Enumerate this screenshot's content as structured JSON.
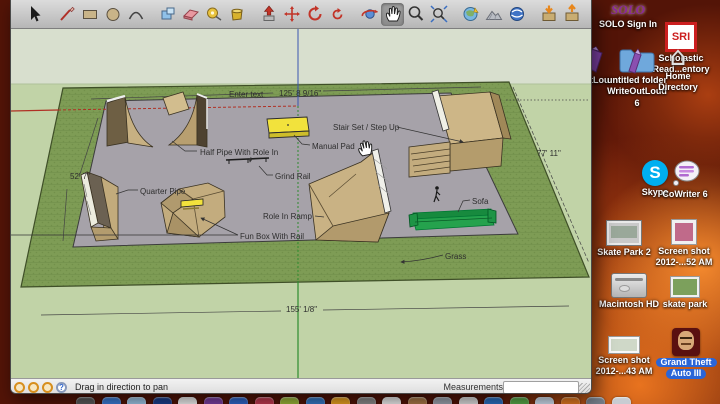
{
  "app": {
    "name": "SketchUp"
  },
  "toolbar": {
    "tools": [
      {
        "id": "select-tool",
        "icon": "select"
      },
      {
        "id": "line-tool",
        "icon": "line",
        "gap": true
      },
      {
        "id": "rectangle-tool",
        "icon": "rectangle"
      },
      {
        "id": "circle-tool",
        "icon": "circle"
      },
      {
        "id": "arc-tool",
        "icon": "arc"
      },
      {
        "id": "make-component-tool",
        "icon": "component",
        "gap": true
      },
      {
        "id": "eraser-tool",
        "icon": "eraser"
      },
      {
        "id": "tape-measure-tool",
        "icon": "tape"
      },
      {
        "id": "paint-bucket-tool",
        "icon": "bucket"
      },
      {
        "id": "push-pull-tool",
        "icon": "pushpull",
        "gap": true
      },
      {
        "id": "move-tool",
        "icon": "move"
      },
      {
        "id": "rotate-tool",
        "icon": "rotate"
      },
      {
        "id": "follow-me-tool",
        "icon": "followme"
      },
      {
        "id": "orbit-tool",
        "icon": "orbit",
        "gap": true
      },
      {
        "id": "pan-tool",
        "icon": "pan",
        "selected": true
      },
      {
        "id": "zoom-tool",
        "icon": "zoom"
      },
      {
        "id": "zoom-extents-tool",
        "icon": "zoomext"
      },
      {
        "id": "add-location-tool",
        "icon": "addloc",
        "gap": true
      },
      {
        "id": "toggle-terrain-tool",
        "icon": "terrain"
      },
      {
        "id": "photo-textures-tool",
        "icon": "phototex"
      },
      {
        "id": "get-models-tool",
        "icon": "getmodels",
        "gap": true
      },
      {
        "id": "share-model-tool",
        "icon": "sharemodel"
      }
    ]
  },
  "statusbar": {
    "hint": "Drag in direction to pan",
    "measurements_label": "Measurements",
    "measurements_value": "",
    "help_glyph": "?"
  },
  "viewport": {
    "cursor": "pan-hand",
    "labels": [
      {
        "id": "enter-text",
        "text": "Enter text",
        "x": 218,
        "y": 61
      },
      {
        "id": "dim-length-top",
        "text": "125' 8 9/16\"",
        "x": 268,
        "y": 60
      },
      {
        "id": "stair-set",
        "text": "Stair Set / Step Up",
        "x": 322,
        "y": 94
      },
      {
        "id": "manual-pad",
        "text": "Manual Pad",
        "x": 301,
        "y": 113
      },
      {
        "id": "half-pipe",
        "text": "Half Pipe With Role In",
        "x": 189,
        "y": 119
      },
      {
        "id": "grind-rail",
        "text": "Grind Rail",
        "x": 264,
        "y": 143
      },
      {
        "id": "quarter-pipe",
        "text": "Quarter Pipe",
        "x": 129,
        "y": 158
      },
      {
        "id": "role-in-ramp",
        "text": "Role  In Ramp",
        "x": 252,
        "y": 183
      },
      {
        "id": "fun-box",
        "text": "Fun Box With Rail",
        "x": 229,
        "y": 203
      },
      {
        "id": "sofa",
        "text": "Sofa",
        "x": 461,
        "y": 168
      },
      {
        "id": "grass",
        "text": "Grass",
        "x": 434,
        "y": 223
      },
      {
        "id": "dim-width-left",
        "text": "52' 7\"",
        "x": 59,
        "y": 143
      },
      {
        "id": "dim-width-right",
        "text": "77' 11\"",
        "x": 526,
        "y": 120
      },
      {
        "id": "dim-length-bottom",
        "text": "155' 1/8\"",
        "x": 275,
        "y": 276
      }
    ]
  },
  "desktop": {
    "icons": [
      {
        "id": "solo",
        "kind": "solo",
        "icon_text": "SOLO",
        "x": 628,
        "y": 2,
        "labels": [
          "SOLO Sign In"
        ]
      },
      {
        "id": "sri",
        "kind": "sri",
        "icon_text": "SRI",
        "x": 681,
        "y": 22,
        "labels": [
          "Scholastic",
          "Read...entory"
        ]
      },
      {
        "id": "writeoutloud-cut",
        "kind": "marker",
        "x": 597,
        "y": 46,
        "labels": [
          "utLou"
        ]
      },
      {
        "id": "untitled-folder",
        "kind": "folder",
        "x": 637,
        "y": 44,
        "labels": [
          "untitled folder",
          "WriteOutLoud",
          "6"
        ]
      },
      {
        "id": "home-directory",
        "kind": "home",
        "x": 678,
        "y": 44,
        "labels": [
          "Home",
          "Directory"
        ]
      },
      {
        "id": "skype",
        "kind": "skype",
        "icon_text": "S",
        "x": 655,
        "y": 160,
        "labels": [
          "Skype"
        ]
      },
      {
        "id": "cowriter-6",
        "kind": "cowriter",
        "x": 685,
        "y": 160,
        "labels": [
          "CoWriter 6"
        ]
      },
      {
        "id": "skate-park-2",
        "kind": "shotgrey",
        "x": 624,
        "y": 220,
        "labels": [
          "Skate Park 2"
        ]
      },
      {
        "id": "screenshot-52",
        "kind": "shotsmall",
        "x": 684,
        "y": 219,
        "labels": [
          "Screen shot",
          "2012-...52 AM"
        ]
      },
      {
        "id": "macintosh-hd",
        "kind": "drive",
        "x": 629,
        "y": 273,
        "labels": [
          "Macintosh HD"
        ]
      },
      {
        "id": "skate-park",
        "kind": "shotgreen",
        "x": 685,
        "y": 276,
        "labels": [
          "skate park"
        ]
      },
      {
        "id": "screenshot-43",
        "kind": "shotwide",
        "x": 624,
        "y": 336,
        "labels": [
          "Screen shot",
          "2012-...43 AM"
        ]
      },
      {
        "id": "grand-theft-auto",
        "kind": "gta",
        "x": 686,
        "y": 328,
        "labels": [
          "Grand Theft",
          "Auto III"
        ],
        "selected": true
      }
    ],
    "dock_colors": [
      "#5a5a5a",
      "#3a7bd5",
      "#9cc4e4",
      "#1a3e8c",
      "#f0f0f0",
      "#7a3fa0",
      "#2e66c9",
      "#c03a50",
      "#9ab53a",
      "#3578c4",
      "#e8a020",
      "#8a8a8a",
      "#ececec",
      "#a87848",
      "#9aa2ae",
      "#dcdcdc",
      "#2a6fc0",
      "#58a848",
      "#cddcec",
      "#e07820",
      "#77808c",
      "#c8ccd2"
    ]
  },
  "colors": {
    "toolbar_grey": "#cfcfcf",
    "viewport_sky": "#d8dfce",
    "viewport_ground": "#c1d3a7",
    "grass_green": "#7e9c55",
    "concrete_grey": "#a6a2a9",
    "wood_tan": "#c7b082",
    "pad_yellow": "#f2e23c",
    "sofa_green": "#1f9648",
    "axis_red": "#b03024",
    "axis_green": "#2e8b2e",
    "axis_blue": "#3a56b0",
    "selection_blue": "#2a65d8",
    "desktop_orange": "#e8731f"
  }
}
